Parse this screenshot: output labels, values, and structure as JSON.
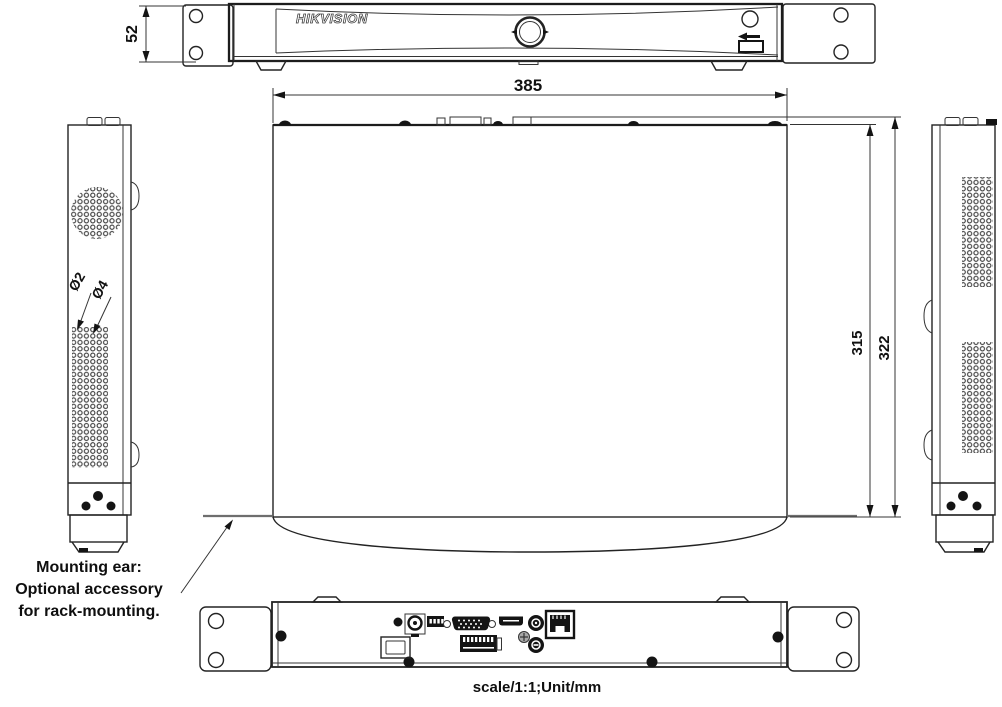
{
  "brand": {
    "logo": "HIKVISION"
  },
  "dimensions": {
    "front_height": "52",
    "top_width": "385",
    "top_depth_inner": "315",
    "top_depth_outer": "322",
    "vent_hole_small": "Ø2",
    "vent_hole_large": "Ø4"
  },
  "notes": {
    "mounting_line1": "Mounting ear:",
    "mounting_line2": "Optional accessory",
    "mounting_line3": "for rack-mounting.",
    "scale": "scale/1:1;Unit/mm"
  },
  "icons": {
    "front_usb": "usb-icon",
    "front_power": "power-indicator-icon"
  },
  "colors": {
    "line": "#232323",
    "background": "#ffffff",
    "ear_line": "#6e6e6e"
  }
}
